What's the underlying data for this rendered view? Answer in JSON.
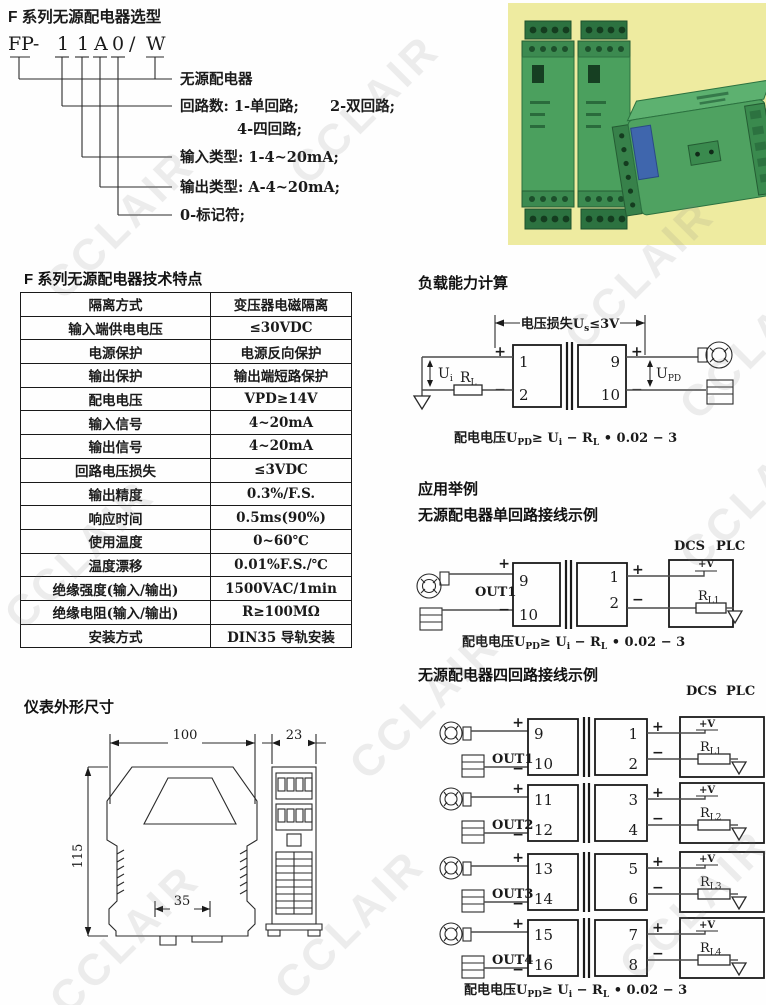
{
  "watermark": {
    "text": "CCLAIR"
  },
  "symbols": {
    "plus": "+",
    "minus": "−",
    "pv": "+V"
  },
  "selection": {
    "title": "F 系列无源配电器选型",
    "code_parts": [
      "FP-",
      "1",
      "1",
      "A",
      "0",
      "/",
      "W"
    ],
    "labels": {
      "l1": "无源配电器",
      "l2a": "回路数: 1-单回路;",
      "l2b": "2-双回路;",
      "l2c": "4-四回路;",
      "l3": "输入类型: 1-4~20mA;",
      "l4": "输出类型: A-4~20mA;",
      "l5": "0-标记符;"
    }
  },
  "photo": {
    "desc": "green DIN-rail distributor modules on yellow background"
  },
  "specs": {
    "title": "F 系列无源配电器技术特点",
    "rows": [
      [
        "隔离方式",
        "变压器电磁隔离"
      ],
      [
        "输入端供电电压",
        "≤30VDC"
      ],
      [
        "电源保护",
        "电源反向保护"
      ],
      [
        "输出保护",
        "输出端短路保护"
      ],
      [
        "配电电压",
        "VPD≥14V"
      ],
      [
        "输入信号",
        "4~20mA"
      ],
      [
        "输出信号",
        "4~20mA"
      ],
      [
        "回路电压损失",
        "≤3VDC"
      ],
      [
        "输出精度",
        "0.3%/F.S."
      ],
      [
        "响应时间",
        "0.5ms(90%)"
      ],
      [
        "使用温度",
        "0~60℃"
      ],
      [
        "温度漂移",
        "0.01%F.S./℃"
      ],
      [
        "绝缘强度(输入/输出)",
        "1500VAC/1min"
      ],
      [
        "绝缘电阻(输入/输出)",
        "R≥100MΩ"
      ],
      [
        "安装方式",
        "DIN35 导轨安装"
      ]
    ]
  },
  "load_calc": {
    "title": "负载能力计算",
    "loss_p1": "电压损失U",
    "loss_s1": "s",
    "loss_p2": "≤3V",
    "t1": "1",
    "t2": "2",
    "t9": "9",
    "t10": "10",
    "ui_b": "U",
    "ui_s": "i",
    "rl_b": "R",
    "rl_s": "L",
    "upd_b": "U",
    "upd_s": "PD"
  },
  "formula": {
    "p1": "配电电压U",
    "s1": "PD",
    "p2": "≥ U",
    "s2": "i",
    "p3": " − R",
    "s3": "L",
    "p4": " • 0.02 − 3"
  },
  "application": {
    "title": "应用举例",
    "single_title": "无源配电器单回路接线示例",
    "dcs": "DCS",
    "plc": "PLC",
    "out1": "OUT1",
    "t9": "9",
    "t10": "10",
    "t1": "1",
    "t2": "2",
    "rl1_b": "R",
    "rl1_s": "L1"
  },
  "four_loop": {
    "title": "无源配电器四回路接线示例",
    "dcs": "DCS",
    "plc": "PLC",
    "loops": [
      {
        "out": "OUT1",
        "a": "9",
        "b": "10",
        "c": "1",
        "d": "2",
        "rb": "R",
        "rs": "L1"
      },
      {
        "out": "OUT2",
        "a": "11",
        "b": "12",
        "c": "3",
        "d": "4",
        "rb": "R",
        "rs": "L2"
      },
      {
        "out": "OUT3",
        "a": "13",
        "b": "14",
        "c": "5",
        "d": "6",
        "rb": "R",
        "rs": "L3"
      },
      {
        "out": "OUT4",
        "a": "15",
        "b": "16",
        "c": "7",
        "d": "8",
        "rb": "R",
        "rs": "L4"
      }
    ]
  },
  "dimensions": {
    "title": "仪表外形尺寸",
    "w": "100",
    "d": "23",
    "h": "115",
    "rail": "35"
  }
}
